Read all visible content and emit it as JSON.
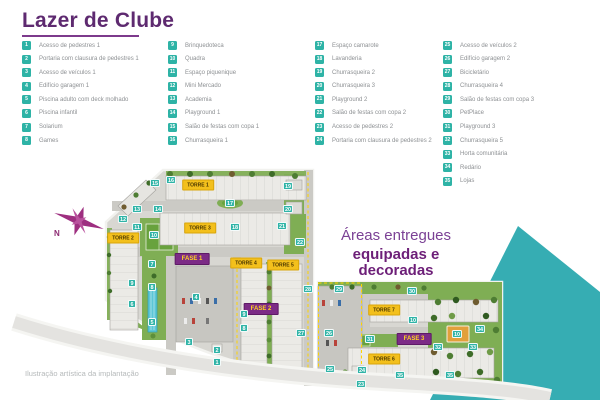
{
  "title": "Lazer de Clube",
  "tagline": {
    "line1": "Áreas entregues",
    "line2": "equipadas e decoradas"
  },
  "caption": "Ilustração artística da implantação",
  "compass_label": "N",
  "colors": {
    "title_purple": "#5e2a70",
    "accent_purple": "#7d3a8c",
    "marker_teal": "#2eb3a6",
    "torre_badge_yellow": "#f3c01c",
    "fase_badge_purple": "#7c2b86",
    "triangle_teal": "#36adb3"
  },
  "legend": {
    "columns": [
      [
        {
          "n": "1",
          "label": "Acesso de pedestres 1"
        },
        {
          "n": "2",
          "label": "Portaria com clausura de pedestres 1"
        },
        {
          "n": "3",
          "label": "Acesso de veículos 1"
        },
        {
          "n": "4",
          "label": "Edifício garagem 1"
        },
        {
          "n": "5",
          "label": "Piscina adulto com deck molhado"
        },
        {
          "n": "6",
          "label": "Piscina infantil"
        },
        {
          "n": "7",
          "label": "Solarium"
        },
        {
          "n": "8",
          "label": "Games"
        }
      ],
      [
        {
          "n": "9",
          "label": "Brinquedoteca"
        },
        {
          "n": "10",
          "label": "Quadra"
        },
        {
          "n": "11",
          "label": "Espaço piquenique"
        },
        {
          "n": "12",
          "label": "Mini Mercado"
        },
        {
          "n": "13",
          "label": "Academia"
        },
        {
          "n": "14",
          "label": "Playground 1"
        },
        {
          "n": "15",
          "label": "Salão de festas com copa 1"
        },
        {
          "n": "16",
          "label": "Churrasqueira 1"
        }
      ],
      [
        {
          "n": "17",
          "label": "Espaço camarote"
        },
        {
          "n": "18",
          "label": "Lavanderia"
        },
        {
          "n": "19",
          "label": "Churrasqueira 2"
        },
        {
          "n": "20",
          "label": "Churrasqueira 3"
        },
        {
          "n": "21",
          "label": "Playground 2"
        },
        {
          "n": "22",
          "label": "Salão de festas com copa 2"
        },
        {
          "n": "23",
          "label": "Acesso de pedestres 2"
        },
        {
          "n": "24",
          "label": "Portaria com clausura de pedestres 2"
        }
      ],
      [
        {
          "n": "25",
          "label": "Acesso de veículos 2"
        },
        {
          "n": "26",
          "label": "Edifício garagem 2"
        },
        {
          "n": "27",
          "label": "Bicicletário"
        },
        {
          "n": "28",
          "label": "Churrasqueira 4"
        },
        {
          "n": "29",
          "label": "Salão de festas com copa 3"
        },
        {
          "n": "30",
          "label": "PetPlace"
        },
        {
          "n": "31",
          "label": "Playground 3"
        },
        {
          "n": "32",
          "label": "Churrasqueira 5"
        },
        {
          "n": "33",
          "label": "Horta comunitária"
        },
        {
          "n": "34",
          "label": "Redário"
        },
        {
          "n": "35",
          "label": "Lojas"
        }
      ]
    ]
  },
  "map": {
    "badges": [
      {
        "type": "torre",
        "label": "TORRE 1",
        "x": 198,
        "y": 185
      },
      {
        "type": "torre",
        "label": "TORRE 2",
        "x": 123,
        "y": 238
      },
      {
        "type": "torre",
        "label": "TORRE 3",
        "x": 200,
        "y": 228
      },
      {
        "type": "torre",
        "label": "TORRE 4",
        "x": 246,
        "y": 263
      },
      {
        "type": "torre",
        "label": "TORRE 5",
        "x": 283,
        "y": 265
      },
      {
        "type": "torre",
        "label": "TORRE 6",
        "x": 384,
        "y": 359
      },
      {
        "type": "torre",
        "label": "TORRE 7",
        "x": 384,
        "y": 310
      },
      {
        "type": "fase",
        "label": "FASE 1",
        "x": 192,
        "y": 259
      },
      {
        "type": "fase",
        "label": "FASE 2",
        "x": 261,
        "y": 309
      },
      {
        "type": "fase",
        "label": "FASE 3",
        "x": 414,
        "y": 339
      }
    ],
    "markers": [
      {
        "n": "1",
        "x": 217,
        "y": 362
      },
      {
        "n": "2",
        "x": 217,
        "y": 350
      },
      {
        "n": "3",
        "x": 189,
        "y": 342
      },
      {
        "n": "4",
        "x": 196,
        "y": 297
      },
      {
        "n": "5",
        "x": 152,
        "y": 322
      },
      {
        "n": "6",
        "x": 132,
        "y": 304
      },
      {
        "n": "7",
        "x": 152,
        "y": 264
      },
      {
        "n": "8",
        "x": 152,
        "y": 287
      },
      {
        "n": "9",
        "x": 132,
        "y": 283
      },
      {
        "n": "8",
        "x": 244,
        "y": 328
      },
      {
        "n": "9",
        "x": 244,
        "y": 314
      },
      {
        "n": "10",
        "x": 154,
        "y": 235
      },
      {
        "n": "10",
        "x": 413,
        "y": 320
      },
      {
        "n": "10",
        "x": 457,
        "y": 334
      },
      {
        "n": "11",
        "x": 137,
        "y": 227
      },
      {
        "n": "12",
        "x": 123,
        "y": 219
      },
      {
        "n": "13",
        "x": 137,
        "y": 209
      },
      {
        "n": "14",
        "x": 158,
        "y": 209
      },
      {
        "n": "15",
        "x": 155,
        "y": 183
      },
      {
        "n": "16",
        "x": 171,
        "y": 180
      },
      {
        "n": "17",
        "x": 230,
        "y": 203
      },
      {
        "n": "18",
        "x": 235,
        "y": 227
      },
      {
        "n": "19",
        "x": 288,
        "y": 186
      },
      {
        "n": "20",
        "x": 288,
        "y": 209
      },
      {
        "n": "21",
        "x": 282,
        "y": 226
      },
      {
        "n": "22",
        "x": 300,
        "y": 242
      },
      {
        "n": "23",
        "x": 361,
        "y": 384
      },
      {
        "n": "24",
        "x": 362,
        "y": 370
      },
      {
        "n": "25",
        "x": 330,
        "y": 369
      },
      {
        "n": "26",
        "x": 329,
        "y": 333
      },
      {
        "n": "27",
        "x": 301,
        "y": 333
      },
      {
        "n": "28",
        "x": 308,
        "y": 289
      },
      {
        "n": "29",
        "x": 339,
        "y": 289
      },
      {
        "n": "30",
        "x": 412,
        "y": 291
      },
      {
        "n": "31",
        "x": 370,
        "y": 339
      },
      {
        "n": "32",
        "x": 438,
        "y": 347
      },
      {
        "n": "33",
        "x": 473,
        "y": 347
      },
      {
        "n": "34",
        "x": 480,
        "y": 329
      },
      {
        "n": "35",
        "x": 400,
        "y": 375
      },
      {
        "n": "35",
        "x": 450,
        "y": 375
      }
    ]
  }
}
